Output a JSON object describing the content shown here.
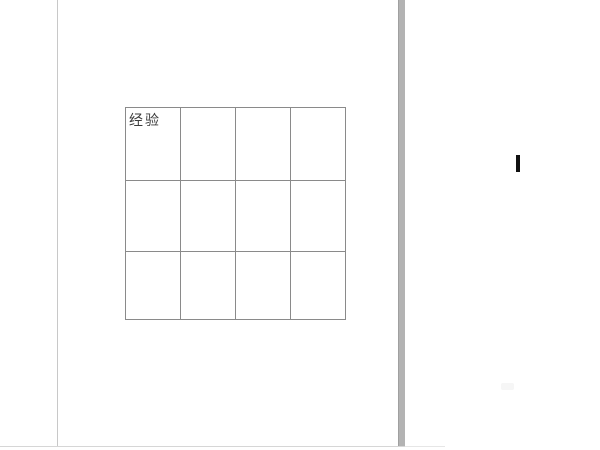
{
  "app": {
    "description": "Word-processor page view with an empty 4x3 table",
    "page_background": "#ffffff"
  },
  "colors": {
    "table_border": "#8a8a8a",
    "page_left_edge": "#c8c8c8",
    "page_right_shadow": "#b3b3b3",
    "page_bottom_edge": "#d6d6d6",
    "text_cursor": "#111111",
    "cell_text": "#3b3b3b"
  },
  "document": {
    "table": {
      "rows": 3,
      "cols": 4,
      "cells": [
        [
          "经验",
          "",
          "",
          ""
        ],
        [
          "",
          "",
          "",
          ""
        ],
        [
          "",
          "",
          "",
          ""
        ]
      ]
    }
  }
}
